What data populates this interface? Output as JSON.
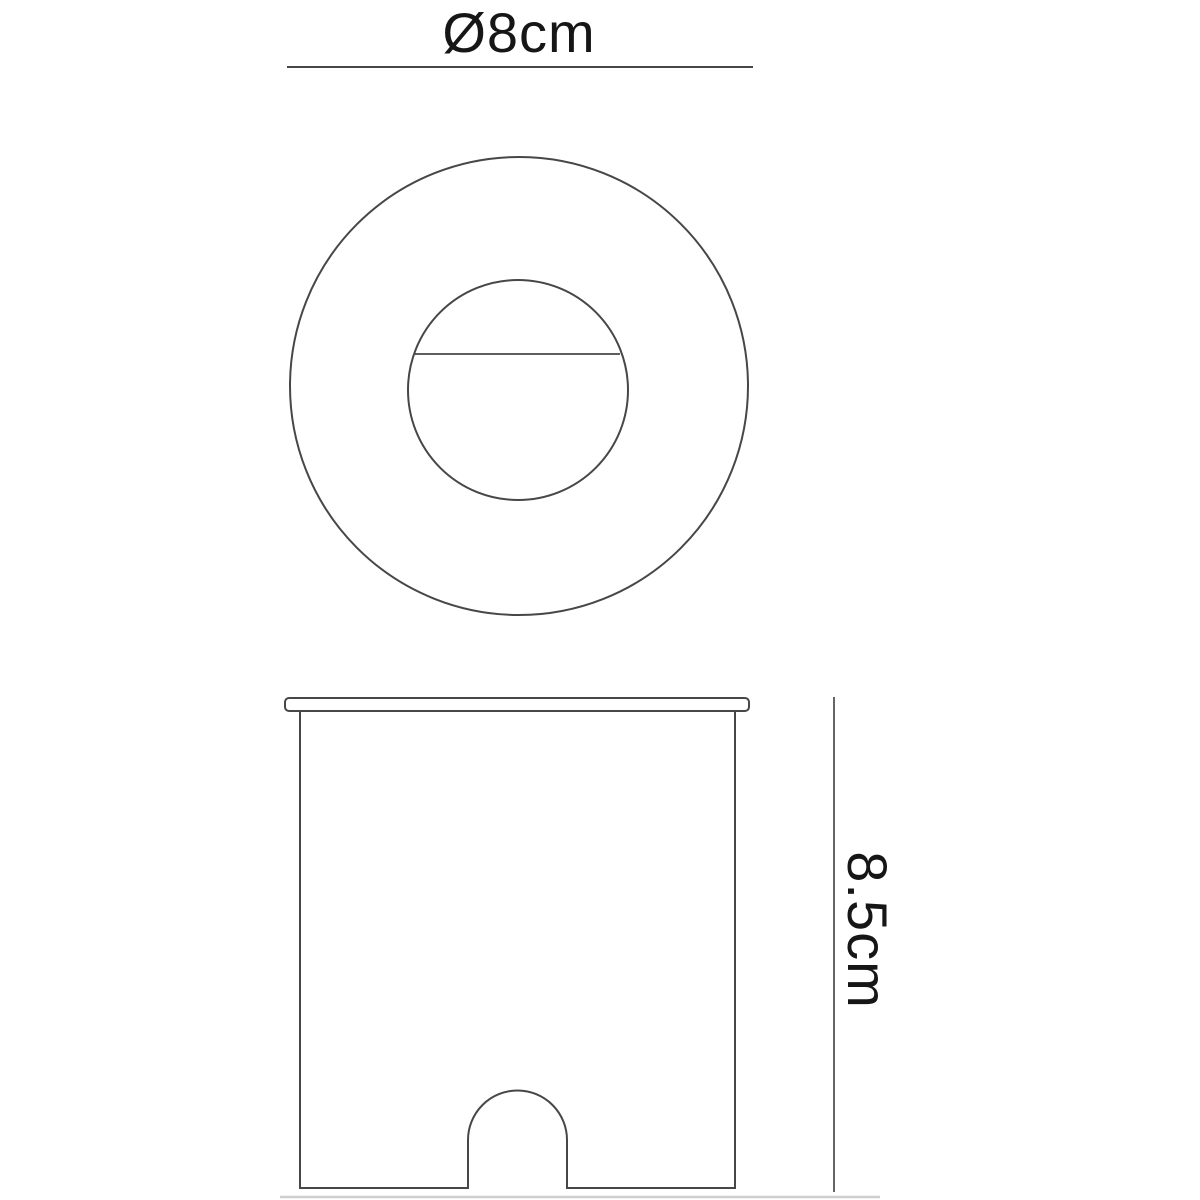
{
  "drawing": {
    "kind": "technical-dimension-drawing",
    "colors": {
      "background": "#ffffff",
      "line": "#474747",
      "thin_line": "#4a4a4a",
      "faint_line": "#cfcfcf",
      "text": "#161616"
    },
    "top_view": {
      "dimension_label": "Ø8cm",
      "diameter_value": "8",
      "unit": "cm"
    },
    "side_view": {
      "dimension_label": "8.5cm",
      "height_value": "8.5",
      "unit": "cm"
    }
  }
}
